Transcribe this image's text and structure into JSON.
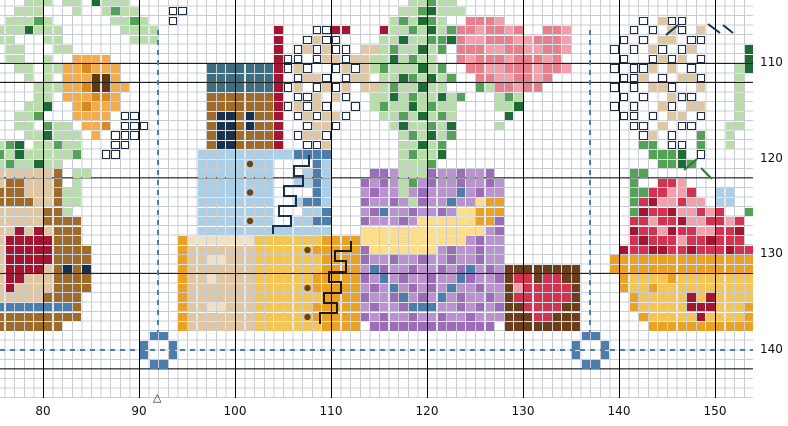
{
  "chart": {
    "type": "cross-stitch-pattern-grid",
    "x_axis_labels": [
      "80",
      "90",
      "100",
      "110",
      "120",
      "130",
      "140",
      "150"
    ],
    "y_axis_labels": [
      "110",
      "120",
      "130",
      "140"
    ],
    "center_marker": "△",
    "colors": {
      "background": "#ffffff",
      "grid_minor": "#c9cdd3",
      "grid_major": "#000000",
      "guide_dashed": "#4d7dab",
      "label_text": "#111111",
      "backstitch_navy": "#16304d",
      "backstitch_black": "#1c1c1c",
      "backstitch_green": "#2e7a3c"
    },
    "motifs": [
      "orange-flower-in-pot",
      "heart-pot",
      "house-gift-boxes",
      "flower-bouquet-in-purple-vase",
      "heart-box",
      "apple-basket",
      "white-lily-sprays",
      "center-ring-markers"
    ]
  },
  "pattern": {
    "palette": {
      "g": {
        "bg": "#b9dcab"
      },
      "G": {
        "bg": "#55a158"
      },
      "D": {
        "bg": "#1d6b35"
      },
      "o": {
        "bg": "#f1ad4d"
      },
      "O": {
        "bg": "#d9891f"
      },
      "B": {
        "bg": "#5e3a12"
      },
      "b": {
        "bg": "#9f6b2b"
      },
      "t": {
        "bg": "#dfc7a3"
      },
      "T": {
        "bg": "#efdfc5"
      },
      "k": {
        "bg": "#16304d"
      },
      "e": {
        "bg": "#3e6d7f"
      },
      "r": {
        "bg": "#a31530"
      },
      "R": {
        "bg": "#d23351"
      },
      "p": {
        "bg": "#f2a0ac"
      },
      "P": {
        "bg": "#e87f8d"
      },
      "c": {
        "bg": "#abcfe7"
      },
      "C": {
        "bg": "#4d7dab"
      },
      "M": {
        "bg": "#b893cd"
      },
      "m": {
        "bg": "#9b6db6"
      },
      "y": {
        "bg": "#f3c456"
      },
      "Y": {
        "bg": "#e9a226"
      },
      "n": {
        "bg": "#fcdd8e"
      },
      "h": {
        "bg": "#6a3e1c"
      },
      "w": {
        "bg": "#ffffff",
        "border": "#1d2e40"
      },
      "d": {
        "bg": "#abcfe7",
        "dot": "#6b4413"
      },
      "E": {
        "bg": "#f3c456",
        "dot": "#6b4413"
      }
    },
    "runs": [
      [
        0,
        3,
        "ggg.gg.Dggg"
      ],
      [
        0,
        43,
        "ggGgg"
      ],
      [
        1,
        2,
        "ggg...g..gGgg"
      ],
      [
        1,
        18,
        "ww"
      ],
      [
        1,
        42,
        "ggGDggg"
      ],
      [
        2,
        1,
        "gggGg"
      ],
      [
        2,
        12,
        "ggGg"
      ],
      [
        2,
        18,
        "w"
      ],
      [
        2,
        41,
        "gGgDGg"
      ],
      [
        2,
        49,
        "PPPp"
      ],
      [
        2,
        67,
        "w.tww"
      ],
      [
        3,
        0,
        "gggDggg"
      ],
      [
        3,
        13,
        "gggg"
      ],
      [
        3,
        29,
        "r"
      ],
      [
        3,
        33,
        "wwrr"
      ],
      [
        3,
        40,
        "rggGgDgGPPpPPpP..PPp"
      ],
      [
        3,
        66,
        "w.w.tw.t"
      ],
      [
        4,
        0,
        "gg...gg"
      ],
      [
        4,
        14,
        "ggg"
      ],
      [
        4,
        29,
        "r"
      ],
      [
        4,
        32,
        "wtww"
      ],
      [
        4,
        40,
        "ggDggGGDPppPPPppPPPp"
      ],
      [
        4,
        65,
        "w.w.tt.ww"
      ],
      [
        5,
        1,
        "gg...gg"
      ],
      [
        5,
        29,
        "r"
      ],
      [
        5,
        31,
        "wtwtww"
      ],
      [
        5,
        38,
        "ttgGggDgG.PPPppPPppPPp"
      ],
      [
        5,
        64,
        "w.w.tw.wt"
      ],
      [
        5,
        78,
        "D"
      ],
      [
        6,
        1,
        "gg..g"
      ],
      [
        6,
        8,
        "oooo"
      ],
      [
        6,
        29,
        "r"
      ],
      [
        6,
        30,
        "ww.wttwttggDgGgg"
      ],
      [
        6,
        48,
        "PpPPPpPPPpP"
      ],
      [
        6,
        65,
        "w..wtwt.w"
      ],
      [
        6,
        78,
        "D"
      ],
      [
        7,
        2,
        "gg.gg"
      ],
      [
        7,
        7,
        "ooOooo"
      ],
      [
        7,
        22,
        "eeeeeee"
      ],
      [
        7,
        29,
        "r"
      ],
      [
        7,
        30,
        "wtw..wtwtgGgggDgG"
      ],
      [
        7,
        49,
        "PPppPPPpPPp"
      ],
      [
        7,
        64,
        "w.wwt.t.w"
      ],
      [
        7,
        77,
        "gD"
      ],
      [
        8,
        3,
        "g.g"
      ],
      [
        8,
        7,
        "oooBBo"
      ],
      [
        8,
        22,
        "eeeeeee"
      ],
      [
        8,
        29,
        "r"
      ],
      [
        8,
        31,
        "wttw.wt"
      ],
      [
        8,
        38,
        "t.ggDGgDgG"
      ],
      [
        8,
        50,
        "PPppPPpP"
      ],
      [
        8,
        65,
        "wwt.w.ttw"
      ],
      [
        8,
        77,
        "g"
      ],
      [
        9,
        4,
        "ggg"
      ],
      [
        9,
        7,
        "ooOBBoo"
      ],
      [
        9,
        22,
        "eeeeeee"
      ],
      [
        9,
        29,
        "r"
      ],
      [
        9,
        30,
        "wt.wtwt"
      ],
      [
        9,
        38,
        "ttgGggDgg"
      ],
      [
        9,
        50,
        "GgPPpPP"
      ],
      [
        9,
        64,
        "w.w.ttw..t"
      ],
      [
        9,
        77,
        "g"
      ],
      [
        10,
        4,
        "gg"
      ],
      [
        10,
        7,
        "oooOOo"
      ],
      [
        10,
        22,
        "bbbbbbb"
      ],
      [
        10,
        29,
        "r"
      ],
      [
        10,
        31,
        "wwt.tw"
      ],
      [
        10,
        39,
        "ggDgGggDgG"
      ],
      [
        10,
        52,
        "gGg"
      ],
      [
        10,
        65,
        "w.w..tww"
      ],
      [
        10,
        77,
        "g"
      ],
      [
        11,
        3,
        "ggD"
      ],
      [
        11,
        8,
        "oOooo"
      ],
      [
        11,
        22,
        "bbbbbbb"
      ],
      [
        11,
        29,
        "r"
      ],
      [
        11,
        30,
        "wtwtw..w"
      ],
      [
        11,
        39,
        "gGggDgGgg"
      ],
      [
        11,
        52,
        "ggD"
      ],
      [
        11,
        64,
        "w.w..tw.tt"
      ],
      [
        11,
        77,
        "g"
      ],
      [
        12,
        2,
        "ggG"
      ],
      [
        12,
        8,
        "oooo"
      ],
      [
        12,
        13,
        "ww"
      ],
      [
        12,
        22,
        "bkkbkbb"
      ],
      [
        12,
        29,
        "r"
      ],
      [
        12,
        31,
        "wtwttw"
      ],
      [
        12,
        40,
        "ggGgDgGg"
      ],
      [
        12,
        53,
        "D"
      ],
      [
        12,
        65,
        "ww.w.tt.w"
      ],
      [
        12,
        77,
        "g"
      ],
      [
        13,
        2,
        "gg.Ggg"
      ],
      [
        13,
        9,
        "ooO"
      ],
      [
        13,
        13,
        "www"
      ],
      [
        13,
        22,
        "bkkbkbb"
      ],
      [
        13,
        29,
        "r"
      ],
      [
        13,
        32,
        "wttw"
      ],
      [
        13,
        41,
        "gDggGgD"
      ],
      [
        13,
        52,
        "g"
      ],
      [
        13,
        66,
        "ww.t.ww"
      ],
      [
        13,
        76,
        "gg"
      ],
      [
        14,
        3,
        "ggDggg"
      ],
      [
        14,
        10,
        "o"
      ],
      [
        14,
        12,
        "www"
      ],
      [
        14,
        22,
        "bkkbbbb"
      ],
      [
        14,
        29,
        "r"
      ],
      [
        14,
        31,
        "wttw"
      ],
      [
        14,
        42,
        "gGgDgG"
      ],
      [
        14,
        67,
        "wt.w..G"
      ],
      [
        14,
        76,
        "g"
      ],
      [
        15,
        0,
        "gGD"
      ],
      [
        15,
        4,
        "ggGgg"
      ],
      [
        15,
        12,
        "ww"
      ],
      [
        15,
        22,
        "bkkbbbb"
      ],
      [
        15,
        29,
        "r"
      ],
      [
        15,
        32,
        "wwt"
      ],
      [
        15,
        42,
        "ggDgG"
      ],
      [
        15,
        67,
        "GG.ww.G"
      ],
      [
        15,
        76,
        "g"
      ],
      [
        16,
        0,
        "GgD"
      ],
      [
        16,
        3,
        "gggggG"
      ],
      [
        16,
        11,
        "ww"
      ],
      [
        16,
        21,
        "ccccccccccCCCC"
      ],
      [
        16,
        42,
        "gGggD"
      ],
      [
        16,
        68,
        "GGGD.w"
      ],
      [
        17,
        0,
        "gG"
      ],
      [
        17,
        2,
        "ggDgg"
      ],
      [
        17,
        21,
        "cccccdcc....Cc"
      ],
      [
        17,
        42,
        "gggG"
      ],
      [
        17,
        69,
        "GGDG"
      ],
      [
        18,
        0,
        "ttttttb"
      ],
      [
        18,
        8,
        "gg"
      ],
      [
        18,
        21,
        "cccccccc...cCc"
      ],
      [
        18,
        39,
        "mmMgggmMMmMMm"
      ],
      [
        18,
        66,
        "GG"
      ],
      [
        19,
        0,
        "tbbtttb"
      ],
      [
        19,
        8,
        "g"
      ],
      [
        19,
        21,
        "cccccccc..ccCc"
      ],
      [
        19,
        38,
        "mMmMgGMmMMmMMmM"
      ],
      [
        19,
        66,
        "G..RRp"
      ],
      [
        20,
        0,
        "bbbtttb"
      ],
      [
        20,
        7,
        "gg"
      ],
      [
        20,
        21,
        "cccccdcc....Cc"
      ],
      [
        20,
        38,
        "MmMMgMmMMMCMmMM"
      ],
      [
        20,
        66,
        "GGRRppR..cc"
      ],
      [
        21,
        0,
        "bbbbttb"
      ],
      [
        21,
        7,
        "gg"
      ],
      [
        21,
        21,
        "cccccccc..cCCc"
      ],
      [
        21,
        38,
        "mMMmMgmMMCMMnYY"
      ],
      [
        21,
        66,
        "GRrppRpp.cc"
      ],
      [
        22,
        0,
        "tttttbb"
      ],
      [
        22,
        7,
        "g"
      ],
      [
        22,
        21,
        "cccccccc...ccC"
      ],
      [
        22,
        38,
        "MmCMMmMMmMnnYYY"
      ],
      [
        22,
        66,
        "GrRRrppRpR..G"
      ],
      [
        23,
        0,
        "tttttbbbb"
      ],
      [
        23,
        21,
        "cccccdcc..ccCC"
      ],
      [
        23,
        38,
        "mMMMmMnnnnnnYYm"
      ],
      [
        23,
        66,
        "RRpRRrppRRpR"
      ],
      [
        24,
        0,
        "ttrtrtbbb"
      ],
      [
        24,
        21,
        "cccccccccccccc"
      ],
      [
        24,
        38,
        "nnnnnnnnnnnnnMm"
      ],
      [
        24,
        66,
        "rRRprRRppRRr"
      ],
      [
        25,
        0,
        "trrrrrbbb"
      ],
      [
        25,
        19,
        "YTTTTTTTyyyyyyyYYYY"
      ],
      [
        25,
        38,
        "nnnnnnnnnnnMmMM"
      ],
      [
        25,
        66,
        "RrRRRpRRrRRR"
      ],
      [
        26,
        0,
        "trrrrrbbbb"
      ],
      [
        26,
        19,
        "YtttttttyyyyyEYYYYY"
      ],
      [
        26,
        38,
        "mnnnnnnnMmMMmMM"
      ],
      [
        26,
        65,
        "rRRrrRRrRRRrRR"
      ],
      [
        27,
        0,
        "trrrrrbbbb"
      ],
      [
        27,
        19,
        "YttTTtttyyyyyyyYYYY"
      ],
      [
        27,
        38,
        "mMMmMMmMMmMMmMM"
      ],
      [
        27,
        64,
        "YYYYYYYYYYYYYYY"
      ],
      [
        28,
        0,
        "trrrrtbkbk"
      ],
      [
        28,
        19,
        "YtttttttyyyyyyyYYYY"
      ],
      [
        28,
        38,
        "MCmMMmMMmMmCMmM"
      ],
      [
        28,
        53,
        "hhhhhhhh"
      ],
      [
        28,
        64,
        "YYYYYYYYYYYYYYY"
      ],
      [
        29,
        0,
        "trrtttbbbb"
      ],
      [
        29,
        19,
        "YttTttttyyyyyyYYYYY"
      ],
      [
        29,
        38,
        "mMCMmMMmMMCmMMm"
      ],
      [
        29,
        53,
        "hRRhRRhh"
      ],
      [
        29,
        65,
        "YyyyyYyyyyyyyy"
      ],
      [
        30,
        0,
        "trttttbbbb"
      ],
      [
        30,
        19,
        "YtttttttyyyyyEYYYYY"
      ],
      [
        30,
        38,
        "MmMCMmMmMCMMmMM"
      ],
      [
        30,
        53,
        "hpRRRRRh"
      ],
      [
        30,
        65,
        "YyyYyyyyyyyyyy"
      ],
      [
        31,
        0,
        "tttttbbbb"
      ],
      [
        31,
        19,
        "YtttttttyyyyyyyYYYY"
      ],
      [
        31,
        38,
        "mMMmCMmMCMmMMmM"
      ],
      [
        31,
        53,
        "hRRRRRRh"
      ],
      [
        31,
        66,
        "Yyyyyyryryyyy"
      ],
      [
        32,
        0,
        "CCCCCCCCb"
      ],
      [
        32,
        19,
        "YttTTtttyyyyyyYYYYY"
      ],
      [
        32,
        38,
        "MmMMmCCCMMmMmMm"
      ],
      [
        32,
        53,
        "hhRRRRhh"
      ],
      [
        32,
        66,
        "YyyyyyrrryyyY"
      ],
      [
        33,
        0,
        "bbbbbbbbb"
      ],
      [
        33,
        19,
        "YtttttttyyyyyEYYYYY"
      ],
      [
        33,
        38,
        "mMmMMmMMmMMmMMM"
      ],
      [
        33,
        53,
        "hhhRRhhh"
      ],
      [
        33,
        67,
        "YyyyyyryyyyY"
      ],
      [
        34,
        0,
        "bbbbbbb"
      ],
      [
        34,
        19,
        "YtttttttyyyyyyyYYYY"
      ],
      [
        34,
        39,
        "mmmmmmmmmmmmm"
      ],
      [
        34,
        53,
        "hhhhhhhh"
      ],
      [
        34,
        68,
        "YYYYYYYYYYY"
      ],
      [
        35,
        16,
        "CC"
      ],
      [
        35,
        61,
        "CC"
      ],
      [
        36,
        15,
        "C..C"
      ],
      [
        36,
        60,
        "C..C"
      ],
      [
        37,
        15,
        "C..C"
      ],
      [
        37,
        60,
        "C..C"
      ],
      [
        38,
        16,
        "CC"
      ],
      [
        38,
        61,
        "CC"
      ]
    ]
  }
}
